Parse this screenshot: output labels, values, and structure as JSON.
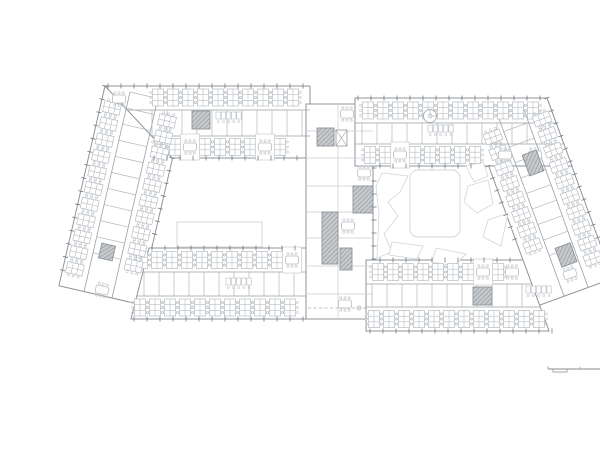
{
  "canvas": {
    "width": 600,
    "height": 424,
    "background": "#ffffff"
  },
  "palette": {
    "wall": "#8f949a",
    "band": "#9aa0a5",
    "cross": "#b0b5ba",
    "furniture": "#b7bcc1",
    "chair": "#c1c6ca",
    "faint": "#c9cdd0",
    "tick": "#74797e",
    "hatch_bg": "#c6cacd",
    "hatch_line": "#84898e",
    "blob": "#d2d5d8",
    "dash": "#a8adb2",
    "scale": "#8a8f94"
  },
  "volumes": [
    {
      "name": "left-wing",
      "pts": [
        65,
        70,
        144.9,
        88.5,
        98.8,
        288.2,
        18.9,
        269.7
      ]
    },
    {
      "name": "right-wing",
      "pts": [
        507,
        82,
        572.7,
        262.5,
        499.4,
        289.2,
        433.7,
        108.7
      ]
    },
    {
      "name": "left-top-bar",
      "pts": [
        65,
        70,
        270,
        70,
        270,
        142,
        132,
        142
      ]
    },
    {
      "name": "left-bottom-bar",
      "pts": [
        109,
        232,
        266,
        232,
        266,
        303,
        91,
        303
      ]
    },
    {
      "name": "central-core",
      "pts": [
        266,
        88,
        333,
        88,
        333,
        303,
        266,
        303
      ]
    },
    {
      "name": "right-top-bar",
      "pts": [
        315,
        82,
        507,
        82,
        532,
        150,
        315,
        150
      ]
    },
    {
      "name": "right-bottom-bar",
      "pts": [
        326,
        244,
        483,
        244,
        509,
        315,
        326,
        315
      ]
    }
  ],
  "band_walls": [
    [
      87,
      94,
      270,
      94
    ],
    [
      112,
      120,
      270,
      120
    ],
    [
      103,
      256,
      266,
      256
    ],
    [
      97,
      280,
      266,
      280
    ],
    [
      315,
      107,
      516,
      107
    ],
    [
      315,
      128,
      524,
      128
    ],
    [
      326,
      268,
      492,
      268
    ],
    [
      326,
      291,
      500,
      291
    ],
    [
      90,
      76,
      44,
      276
    ],
    [
      118,
      82,
      72,
      282
    ],
    [
      483,
      91,
      548,
      271
    ],
    [
      458,
      100,
      524,
      280
    ]
  ],
  "faint_walls": [
    [
      298,
      88,
      298,
      303
    ],
    [
      266,
      115,
      333,
      115
    ],
    [
      266,
      142,
      333,
      142
    ],
    [
      266,
      170,
      333,
      170
    ],
    [
      266,
      196,
      333,
      196
    ],
    [
      266,
      222,
      333,
      222
    ],
    [
      266,
      250,
      333,
      250
    ],
    [
      266,
      278,
      333,
      278
    ]
  ],
  "cross_walls": [
    {
      "x": 112,
      "y": 94,
      "a": 0,
      "nd": 90,
      "n": 11,
      "s": 15,
      "len": 26
    },
    {
      "x": 104,
      "y": 256,
      "a": 0,
      "nd": 90,
      "n": 11,
      "s": 15,
      "len": 24
    },
    {
      "x": 322,
      "y": 107,
      "a": 0,
      "nd": 90,
      "n": 13,
      "s": 15,
      "len": 21
    },
    {
      "x": 332,
      "y": 268,
      "a": 0,
      "nd": 90,
      "n": 11,
      "s": 15,
      "len": 23
    },
    {
      "x": 90,
      "y": 76,
      "a": 103,
      "nd": 13,
      "n": 11,
      "s": 16.5,
      "len": 28
    },
    {
      "x": 483,
      "y": 91,
      "a": 70,
      "nd": 160,
      "n": 10,
      "s": 16.5,
      "len": 26
    }
  ],
  "desk_bands": [
    {
      "x": 118,
      "y": 81.5,
      "a": 0,
      "n": 10,
      "s": 15
    },
    {
      "x": 120,
      "y": 131,
      "a": 0,
      "n": 9,
      "s": 15
    },
    {
      "x": 102,
      "y": 244,
      "a": 0,
      "n": 11,
      "s": 15
    },
    {
      "x": 100,
      "y": 291.5,
      "a": 0,
      "n": 11,
      "s": 15
    },
    {
      "x": 328,
      "y": 94.5,
      "a": 0,
      "n": 12,
      "s": 15
    },
    {
      "x": 330,
      "y": 139,
      "a": 0,
      "n": 8,
      "s": 15
    },
    {
      "x": 338,
      "y": 256,
      "a": 0,
      "n": 9,
      "s": 15
    },
    {
      "x": 334,
      "y": 303,
      "a": 0,
      "n": 12,
      "s": 15
    },
    {
      "x": 72,
      "y": 92,
      "a": 103,
      "n": 11,
      "s": 16.5
    },
    {
      "x": 127,
      "y": 105,
      "a": 103,
      "n": 10,
      "s": 16.5
    },
    {
      "x": 502,
      "y": 103,
      "a": 70,
      "n": 10,
      "s": 16.5
    },
    {
      "x": 453,
      "y": 121,
      "a": 70,
      "n": 8,
      "s": 16.5
    }
  ],
  "tables": [
    {
      "x": 79,
      "y": 83,
      "a": 0,
      "back": false
    },
    {
      "x": 150,
      "y": 131,
      "a": 0,
      "back": true
    },
    {
      "x": 225,
      "y": 131,
      "a": 0,
      "back": true
    },
    {
      "x": 307,
      "y": 98,
      "a": 0,
      "back": false
    },
    {
      "x": 308,
      "y": 210,
      "a": 0,
      "back": false
    },
    {
      "x": 305,
      "y": 288,
      "a": 0,
      "back": false
    },
    {
      "x": 324,
      "y": 157,
      "a": 0,
      "back": false
    },
    {
      "x": 360,
      "y": 139,
      "a": 0,
      "back": true
    },
    {
      "x": 465,
      "y": 139,
      "a": 0,
      "back": false
    },
    {
      "x": 495,
      "y": 139,
      "a": 0,
      "back": false
    },
    {
      "x": 252,
      "y": 244,
      "a": 0,
      "back": true
    },
    {
      "x": 443,
      "y": 256,
      "a": 0,
      "back": true
    },
    {
      "x": 472,
      "y": 256,
      "a": 0,
      "back": false
    },
    {
      "x": 62,
      "y": 274,
      "a": 13,
      "back": false
    },
    {
      "x": 530,
      "y": 258,
      "a": -20,
      "back": false
    }
  ],
  "stairs": [
    {
      "cx": 161,
      "cy": 104,
      "w": 18,
      "h": 18,
      "a": 0
    },
    {
      "cx": 285.5,
      "cy": 121,
      "w": 17,
      "h": 18,
      "a": 0
    },
    {
      "cx": 290,
      "cy": 222,
      "w": 16,
      "h": 52,
      "a": 0
    },
    {
      "cx": 323,
      "cy": 183.5,
      "w": 20,
      "h": 27,
      "a": 0
    },
    {
      "cx": 306,
      "cy": 243,
      "w": 12,
      "h": 22,
      "a": 0
    },
    {
      "cx": 442.5,
      "cy": 280,
      "w": 19,
      "h": 18,
      "a": 0
    },
    {
      "cx": 493,
      "cy": 147,
      "w": 15,
      "h": 22,
      "a": -20
    },
    {
      "cx": 526,
      "cy": 239,
      "w": 16,
      "h": 20,
      "a": -20
    },
    {
      "cx": 67,
      "cy": 236,
      "w": 14,
      "h": 15,
      "a": 13
    }
  ],
  "lift": {
    "cx": 301.5,
    "cy": 122,
    "w": 11,
    "h": 16
  },
  "spiral_stair": {
    "cx": 390,
    "cy": 100,
    "r": 6.5
  },
  "stalls": [
    {
      "x": 176,
      "y": 96
    },
    {
      "x": 388,
      "y": 109
    },
    {
      "x": 186,
      "y": 262
    },
    {
      "x": 486,
      "y": 270
    }
  ],
  "ticks": [
    {
      "x": 68,
      "y": 70,
      "a": 0,
      "n": 16,
      "s": 13
    },
    {
      "x": 94,
      "y": 303,
      "a": 0,
      "n": 14,
      "s": 13
    },
    {
      "x": 114,
      "y": 142,
      "a": 0,
      "n": 12,
      "s": 13
    },
    {
      "x": 112,
      "y": 232,
      "a": 0,
      "n": 12,
      "s": 13
    },
    {
      "x": 318,
      "y": 82,
      "a": 0,
      "n": 15,
      "s": 13
    },
    {
      "x": 330,
      "y": 315,
      "a": 0,
      "n": 15,
      "s": 13
    },
    {
      "x": 334,
      "y": 152,
      "a": 90,
      "n": 8,
      "s": 13
    },
    {
      "x": 340,
      "y": 150,
      "a": 0,
      "n": 8,
      "s": 13
    },
    {
      "x": 340,
      "y": 244,
      "a": 0,
      "n": 11,
      "s": 13
    },
    {
      "x": 65,
      "y": 70,
      "a": 103,
      "n": 15,
      "s": 13.5
    },
    {
      "x": 507,
      "y": 82,
      "a": 70,
      "n": 14,
      "s": 13.5
    },
    {
      "x": 132,
      "y": 142,
      "a": 103,
      "n": 7,
      "s": 13
    },
    {
      "x": 448,
      "y": 150,
      "a": 70,
      "n": 7,
      "s": 13
    }
  ],
  "dashed_link": {
    "x1": 268,
    "y1": 292,
    "x2": 326,
    "y2": 292,
    "dot_x": 319
  },
  "courtyard_left": {
    "rect": {
      "x": 137,
      "y": 206,
      "w": 85,
      "h": 25
    }
  },
  "courtyard_right": {
    "square": {
      "x": 370,
      "y": 154,
      "w": 50,
      "h": 67,
      "r": 8
    },
    "blobs": [
      [
        342,
        157,
        368,
        160,
        360,
        176,
        348,
        186,
        358,
        200,
        344,
        218,
        352,
        236,
        337,
        242,
        339,
        198,
        336,
        170
      ],
      [
        426,
        150,
        443,
        146,
        448,
        160,
        434,
        166
      ],
      [
        428,
        170,
        448,
        164,
        453,
        188,
        437,
        197,
        424,
        186
      ],
      [
        448,
        204,
        468,
        197,
        461,
        230,
        443,
        221
      ],
      [
        352,
        226,
        383,
        230,
        377,
        243,
        349,
        239
      ],
      [
        396,
        232,
        426,
        238,
        414,
        250,
        392,
        246
      ]
    ]
  },
  "scale_bar": {
    "x": 508,
    "y": 353,
    "len": 60
  },
  "north_arrow": {
    "cx": 578,
    "cy": 351,
    "r": 4.5
  }
}
